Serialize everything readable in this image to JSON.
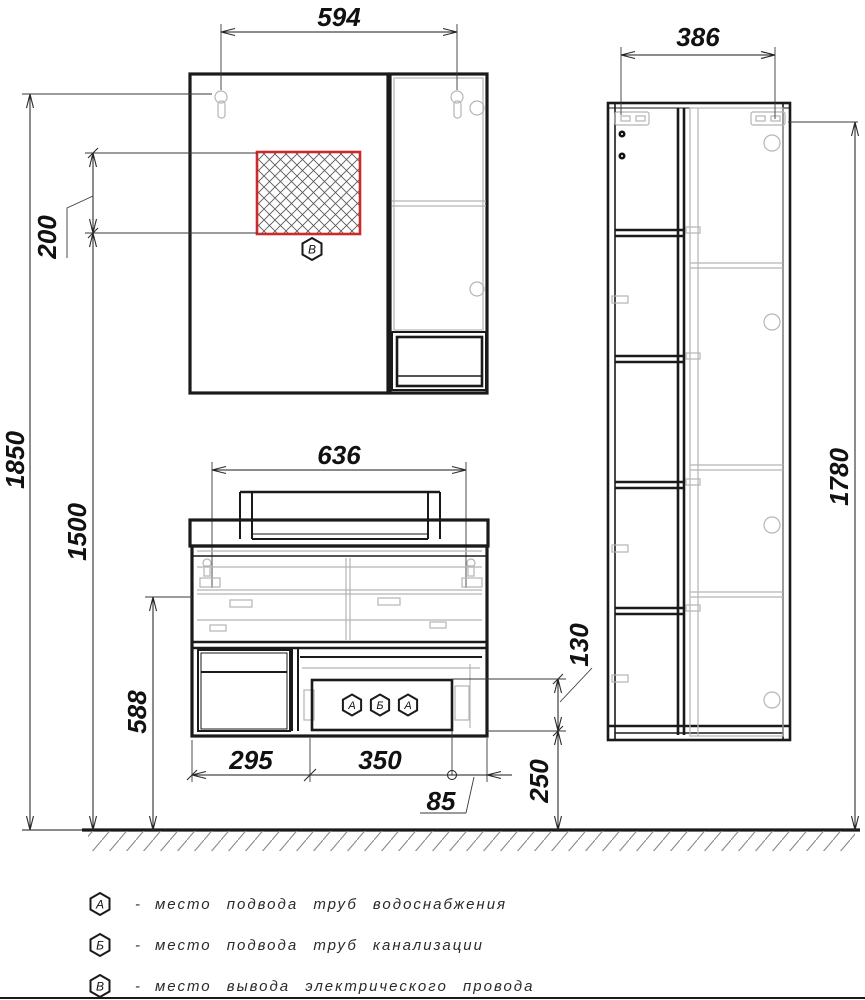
{
  "drawing": {
    "dimensions": {
      "mirror_hangers_span": "594",
      "column_hangers_span": "386",
      "outlet_zone_height": "200",
      "mirror_hanger_height": "1850",
      "outlet_zone_bottom_height": "1500",
      "vanity_hanger_height": "588",
      "vanity_hangers_span": "636",
      "door_section_width": "295",
      "drawer_section_width": "350",
      "drain_right_offset": "85",
      "utility_zone_height": "130",
      "utility_zone_bottom_height": "250",
      "column_height": "1780"
    },
    "symbols": {
      "water": "А",
      "sewage": "Б",
      "electric": "В"
    },
    "legend": [
      {
        "symbol": "А",
        "prefix": "-",
        "text": "место подвода труб водоснабжения"
      },
      {
        "symbol": "Б",
        "prefix": "-",
        "text": "место подвода труб канализации"
      },
      {
        "symbol": "В",
        "prefix": "-",
        "text": "место вывода электрического провода"
      }
    ],
    "colors": {
      "line": "#1a1a1a",
      "detail_gray": "#b5b5b5",
      "outlet_zone_red": "#cc2b2b"
    }
  }
}
